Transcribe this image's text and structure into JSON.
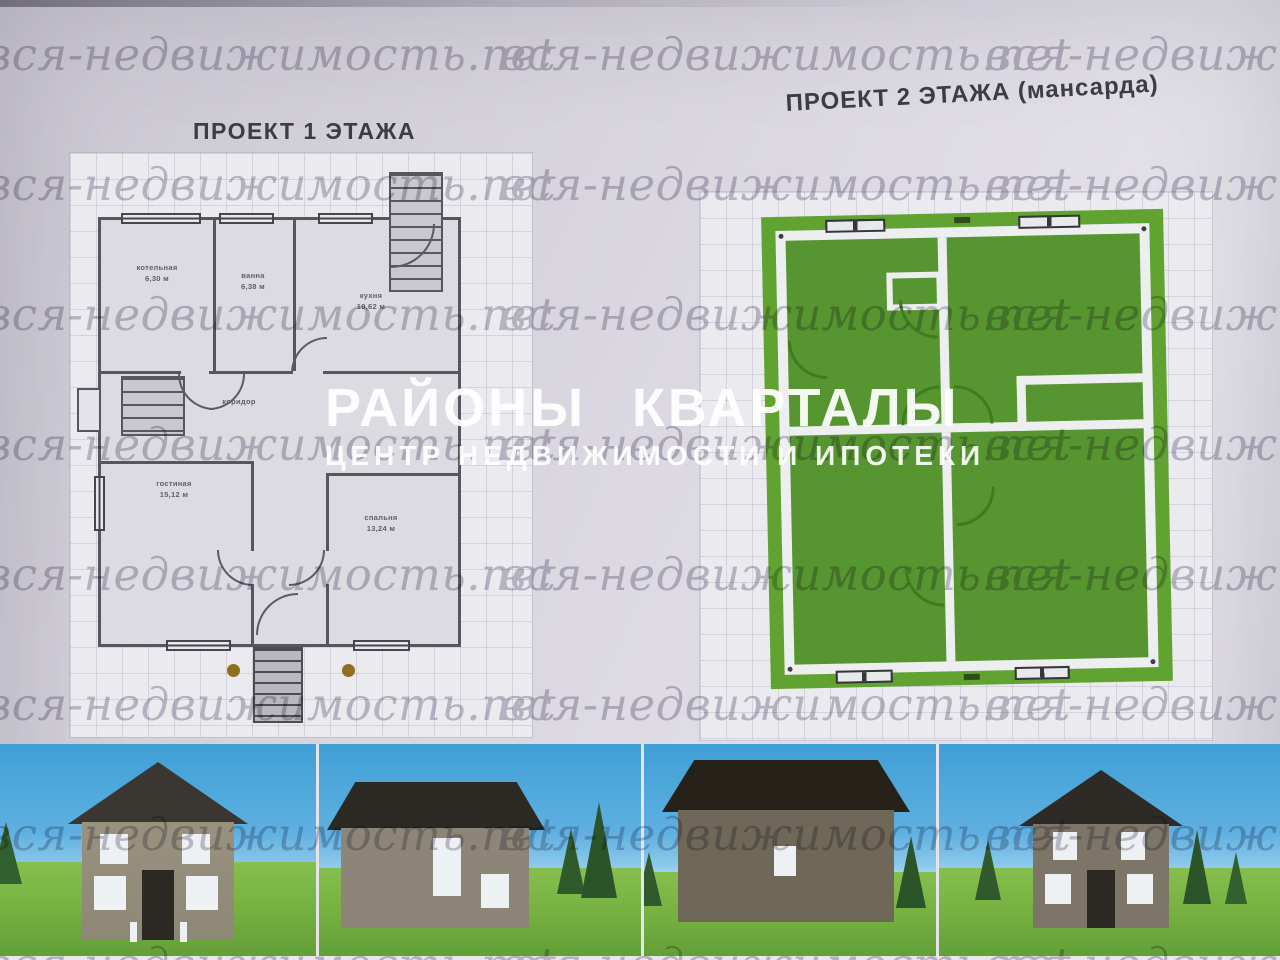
{
  "watermark": {
    "text": "вся-недвижимость.net"
  },
  "brand": {
    "title": "РАЙОНЫ КВАРТАЛЫ",
    "subtitle": "ЦЕНТР НЕДВИЖИМОСТИ И ИПОТЕКИ"
  },
  "plan1": {
    "title": "ПРОЕКТ 1 ЭТАЖА",
    "rooms": [
      {
        "name": "котельная",
        "area": "6,30 м"
      },
      {
        "name": "ванна",
        "area": "6,38 м"
      },
      {
        "name": "кухня",
        "area": "19,62 м"
      },
      {
        "name": "коридор",
        "area": ""
      },
      {
        "name": "гостиная",
        "area": "15,12 м"
      },
      {
        "name": "спальня",
        "area": "13,24 м"
      }
    ]
  },
  "plan2": {
    "title": "ПРОЕКТ 2 ЭТАЖА (мансарда)"
  },
  "colors": {
    "paper": "#d6d3dc",
    "watermark_gray": "#b6b3c1",
    "plan_green": "#569530",
    "plan_green_border": "#61a331",
    "wall_dark": "#56565e",
    "logo_white": "#ffffff",
    "sky_blue": "#4ea7dc",
    "grass_green": "#74af40",
    "roof_dark": "#2c2824"
  }
}
